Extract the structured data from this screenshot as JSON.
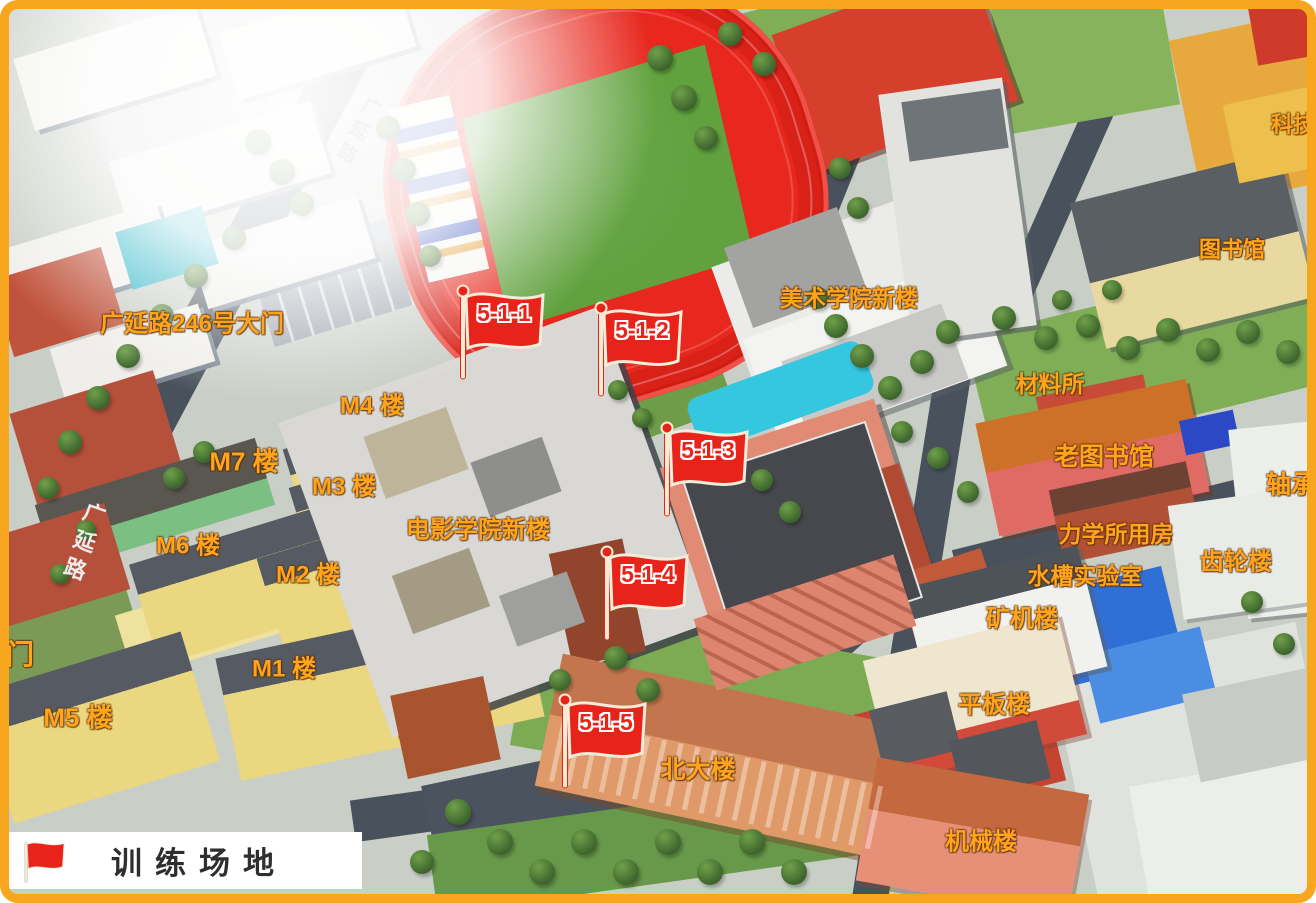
{
  "frame": {
    "border_color": "#F9A61F"
  },
  "legend": {
    "label": "训练场地",
    "flag_color": "#e8231a"
  },
  "flags": [
    {
      "id": "flag-5-1-1",
      "label": "5-1-1",
      "x": 463,
      "y": 291
    },
    {
      "id": "flag-5-1-2",
      "label": "5-1-2",
      "x": 601,
      "y": 308
    },
    {
      "id": "flag-5-1-3",
      "label": "5-1-3",
      "x": 667,
      "y": 428
    },
    {
      "id": "flag-5-1-4",
      "label": "5-1-4",
      "x": 607,
      "y": 552
    },
    {
      "id": "flag-5-1-5",
      "label": "5-1-5",
      "x": 565,
      "y": 700
    }
  ],
  "building_labels": [
    {
      "id": "gate-246",
      "text": "广延路246号大门",
      "x": 192,
      "y": 321,
      "size": 24
    },
    {
      "id": "m4-building",
      "text": "M4 楼",
      "x": 372,
      "y": 403,
      "size": 24
    },
    {
      "id": "m7-building",
      "text": "M7 楼",
      "x": 244,
      "y": 460,
      "size": 26
    },
    {
      "id": "m3-building",
      "text": "M3 楼",
      "x": 344,
      "y": 484,
      "size": 24
    },
    {
      "id": "m6-building",
      "text": "M6 楼",
      "x": 188,
      "y": 543,
      "size": 24
    },
    {
      "id": "m2-building",
      "text": "M2 楼",
      "x": 308,
      "y": 572,
      "size": 24
    },
    {
      "id": "film-academy",
      "text": "电影学院新楼",
      "x": 478,
      "y": 527,
      "size": 24
    },
    {
      "id": "m1-building",
      "text": "M1 楼",
      "x": 284,
      "y": 666,
      "size": 24
    },
    {
      "id": "west-gate",
      "text": "门",
      "x": 20,
      "y": 653,
      "size": 28
    },
    {
      "id": "m5-building",
      "text": "M5 楼",
      "x": 78,
      "y": 716,
      "size": 26
    },
    {
      "id": "art-academy",
      "text": "美术学院新楼",
      "x": 849,
      "y": 296,
      "size": 23
    },
    {
      "id": "keji-building",
      "text": "科技",
      "x": 1293,
      "y": 123,
      "size": 22
    },
    {
      "id": "library",
      "text": "图书馆",
      "x": 1232,
      "y": 248,
      "size": 22
    },
    {
      "id": "materials-inst",
      "text": "材料所",
      "x": 1050,
      "y": 382,
      "size": 23
    },
    {
      "id": "old-library",
      "text": "老图书馆",
      "x": 1104,
      "y": 455,
      "size": 25
    },
    {
      "id": "bearing",
      "text": "轴承",
      "x": 1291,
      "y": 483,
      "size": 25
    },
    {
      "id": "mechanics-rooms",
      "text": "力学所用房",
      "x": 1116,
      "y": 532,
      "size": 23
    },
    {
      "id": "gear-building",
      "text": "齿轮楼",
      "x": 1236,
      "y": 559,
      "size": 24
    },
    {
      "id": "sink-lab",
      "text": "水槽实验室",
      "x": 1085,
      "y": 574,
      "size": 23
    },
    {
      "id": "mining-building",
      "text": "矿机楼",
      "x": 1022,
      "y": 616,
      "size": 24
    },
    {
      "id": "flat-building",
      "text": "平板楼",
      "x": 994,
      "y": 702,
      "size": 24
    },
    {
      "id": "north-building",
      "text": "北大楼",
      "x": 698,
      "y": 768,
      "size": 25
    },
    {
      "id": "machinery-bldg",
      "text": "机械楼",
      "x": 981,
      "y": 839,
      "size": 24
    }
  ],
  "road_labels": [
    {
      "id": "road-guangyan-north",
      "text": "广延路",
      "x": 352,
      "y": 138,
      "rotate": 28,
      "size": 19
    },
    {
      "id": "road-guangyan-west",
      "text": "广延路",
      "x": 77,
      "y": 545,
      "rotate": 19,
      "size": 22
    }
  ],
  "colors": {
    "label_orange": "#FFA41C",
    "flag_red": "#E8231A",
    "track_red": "#E8281E",
    "field_green": "#61A23F",
    "road_dark": "#49525C"
  }
}
